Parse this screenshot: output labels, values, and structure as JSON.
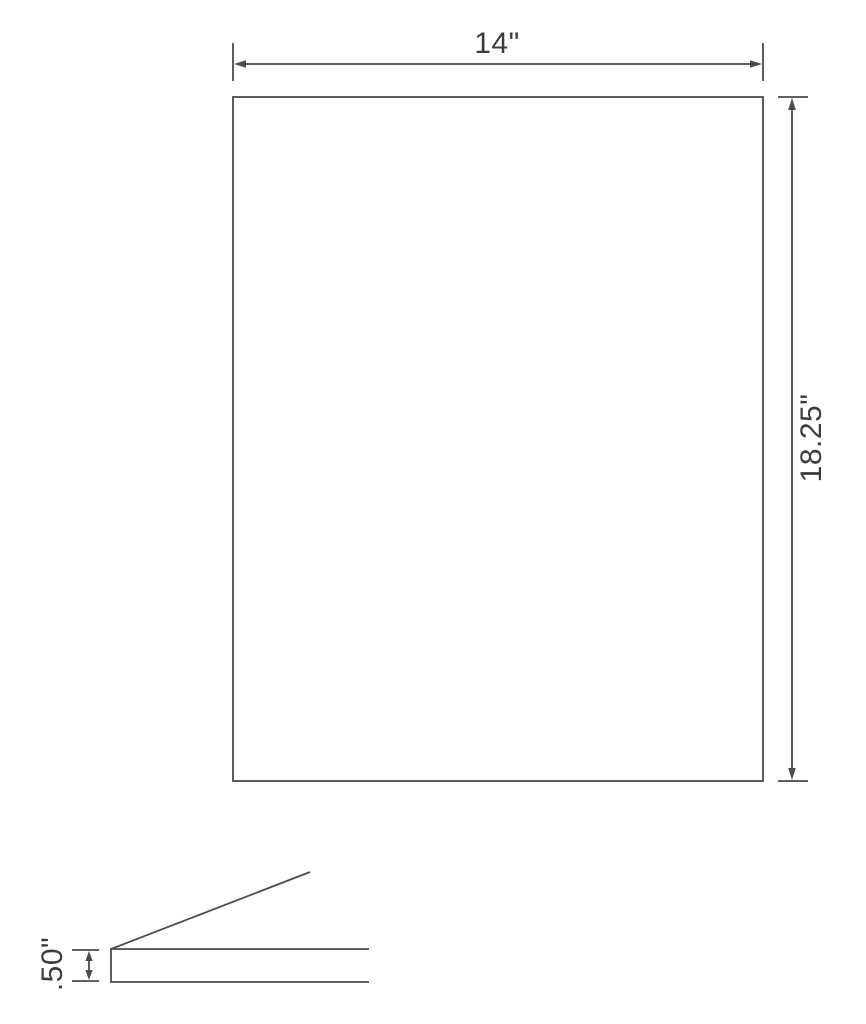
{
  "colors": {
    "line": "#4a4a4a",
    "text": "#3c3c3c",
    "bg": "#ffffff"
  },
  "drawing": {
    "front_view": {
      "width_label": "14\"",
      "height_label": "18.25\""
    },
    "side_view": {
      "thickness_label": ".50\""
    }
  }
}
